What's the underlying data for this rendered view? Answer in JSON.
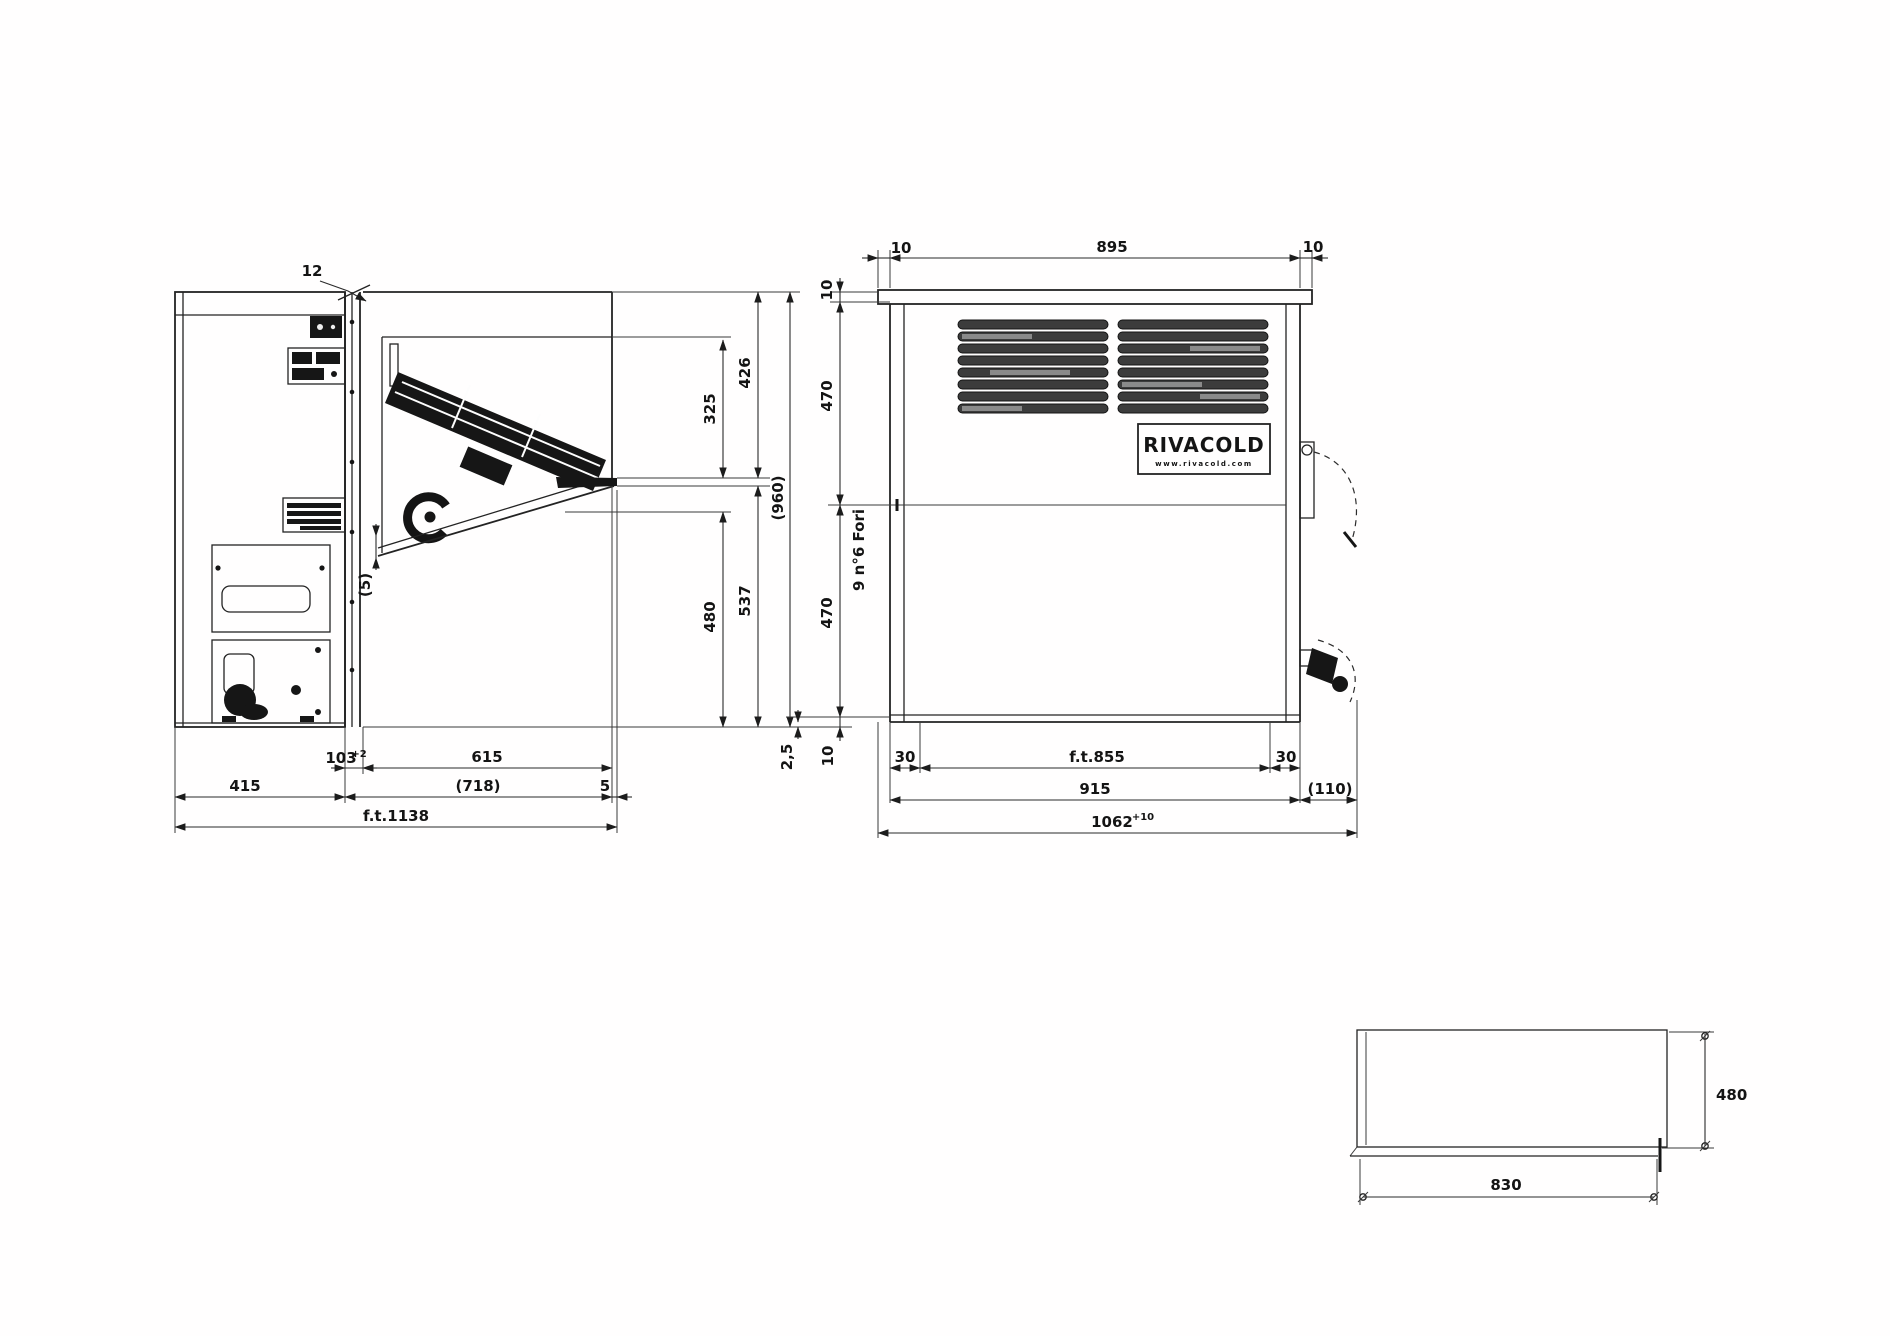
{
  "side_view": {
    "dim_12": "12",
    "dim_325": "325",
    "dim_426": "426",
    "dim_480": "480",
    "dim_537": "537",
    "dim_gap": "(5)",
    "dim_wall": "103",
    "dim_wall_tol": "+2",
    "dim_615": "615",
    "dim_415": "415",
    "dim_718": "(718)",
    "dim_5": "5",
    "dim_total": "f.t.1138"
  },
  "overall_height": "(960)",
  "front_view": {
    "dim_10_top_left": "10",
    "dim_895": "895",
    "dim_10_top_right": "10",
    "dim_10_left_top": "10",
    "dim_470_upper": "470",
    "dim_470_lower": "470",
    "dim_10_left_bottom": "10",
    "dim_2_5": "2,5",
    "holes_note": "9 n°6 Fori",
    "dim_30_left": "30",
    "dim_ft855": "f.t.855",
    "dim_30_right": "30",
    "dim_915": "915",
    "dim_110": "(110)",
    "dim_1062": "1062",
    "dim_1062_tol": "+10",
    "logo_brand": "RIVACOLD",
    "logo_site": "www.rivacold.com"
  },
  "cutout_view": {
    "dim_480": "480",
    "dim_830": "830"
  }
}
